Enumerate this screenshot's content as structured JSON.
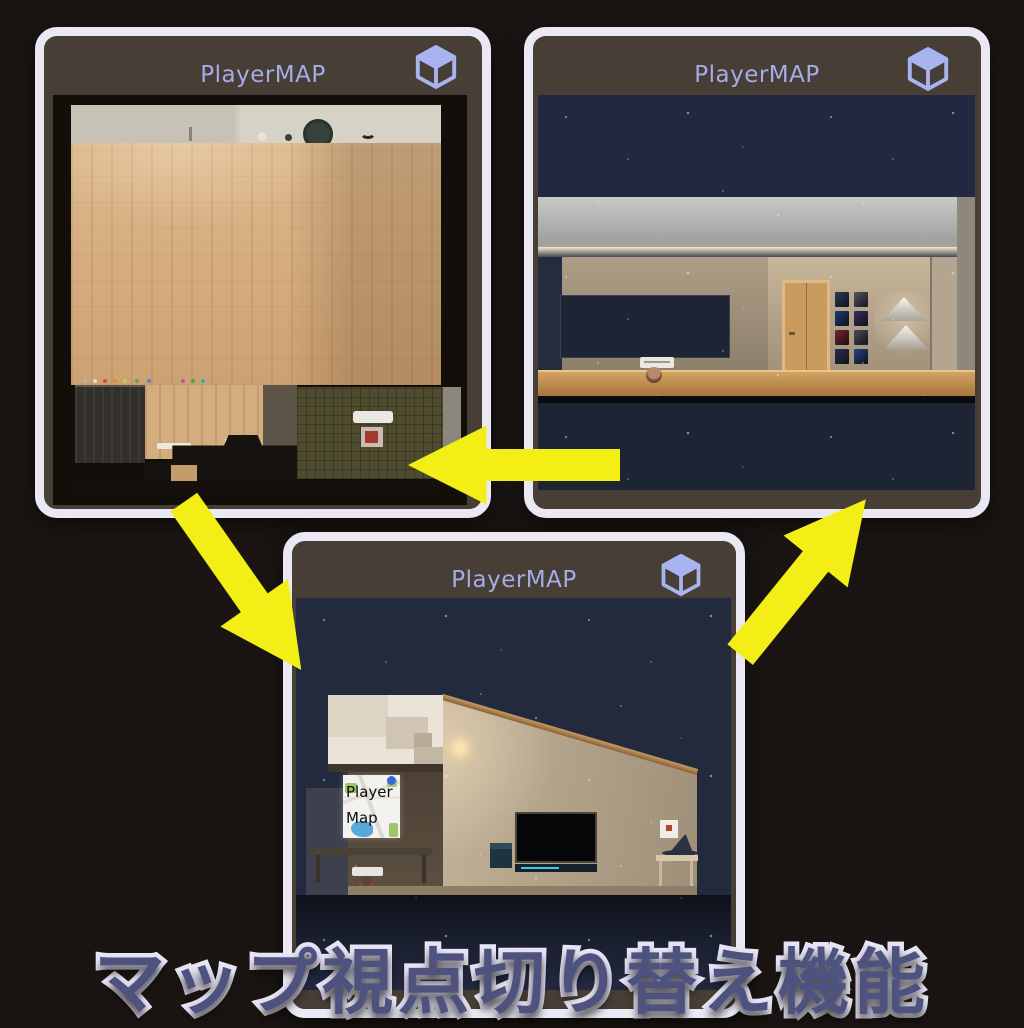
{
  "caption": {
    "text": "マップ視点切り替え機能"
  },
  "panels": [
    {
      "title": "PlayerMAP",
      "view": "overhead-room-map"
    },
    {
      "title": "PlayerMAP",
      "view": "side-cutaway-night-map"
    },
    {
      "title": "PlayerMAP",
      "view": "exterior-night-map"
    }
  ],
  "player_map_sign": {
    "line1": "Player",
    "line2": "Map"
  },
  "icons": {
    "cube": "cube-view-toggle"
  },
  "arrows": [
    {
      "direction": "left"
    },
    {
      "direction": "down-right"
    },
    {
      "direction": "up-right"
    }
  ],
  "colors": {
    "background": "#1a1512",
    "panel_border": "#eae8f3",
    "panel_background": "#473e35",
    "title_text": "#a5ace8",
    "cube_icon": "#a9b3f0",
    "arrow": "#f3ef16",
    "caption_fill": "#4d527e",
    "caption_outline": "#e8e5f6"
  }
}
